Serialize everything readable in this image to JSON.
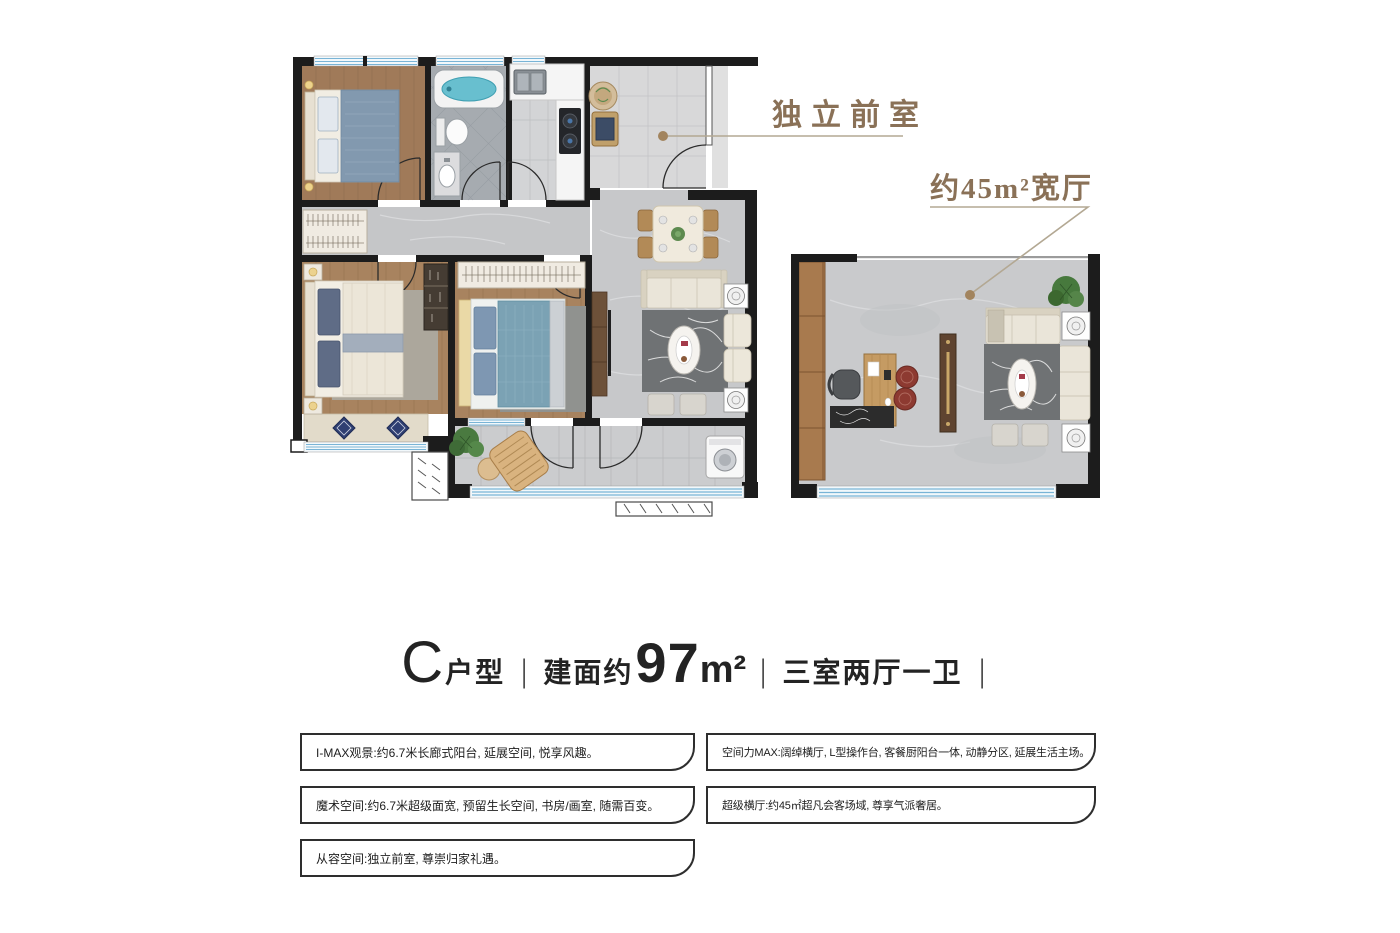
{
  "annotations": {
    "front_room_label": "独立前室",
    "hall_area_label": "约45m²宽厅"
  },
  "title": {
    "type_letter": "C",
    "type_suffix": "户型",
    "separator": "|",
    "area_prefix": "建面约",
    "area_value": "97",
    "area_unit": "m²",
    "layout_text": "三室两厅一卫"
  },
  "features": {
    "left": [
      "I-MAX观景:约6.7米长廊式阳台, 延展空间, 悦享风趣。",
      "魔术空间:约6.7米超级面宽, 预留生长空间, 书房/画室, 随需百变。",
      "从容空间:独立前室, 尊崇归家礼遇。"
    ],
    "right": [
      "空间力MAX:阔绰横厅, L型操作台, 客餐厨阳台一体, 动静分区, 延展生活主场。",
      "超级横厅:约45㎡超凡会客场域, 尊享气派奢居。"
    ]
  },
  "colors": {
    "label_brown": "#8a7157",
    "leader_line": "#b3a893",
    "dot_brown": "#a2845e",
    "wall_black": "#1c1c1c",
    "window_blue": "#79b4d6",
    "box_border": "#2e2e2e",
    "title_dark": "#232323"
  }
}
